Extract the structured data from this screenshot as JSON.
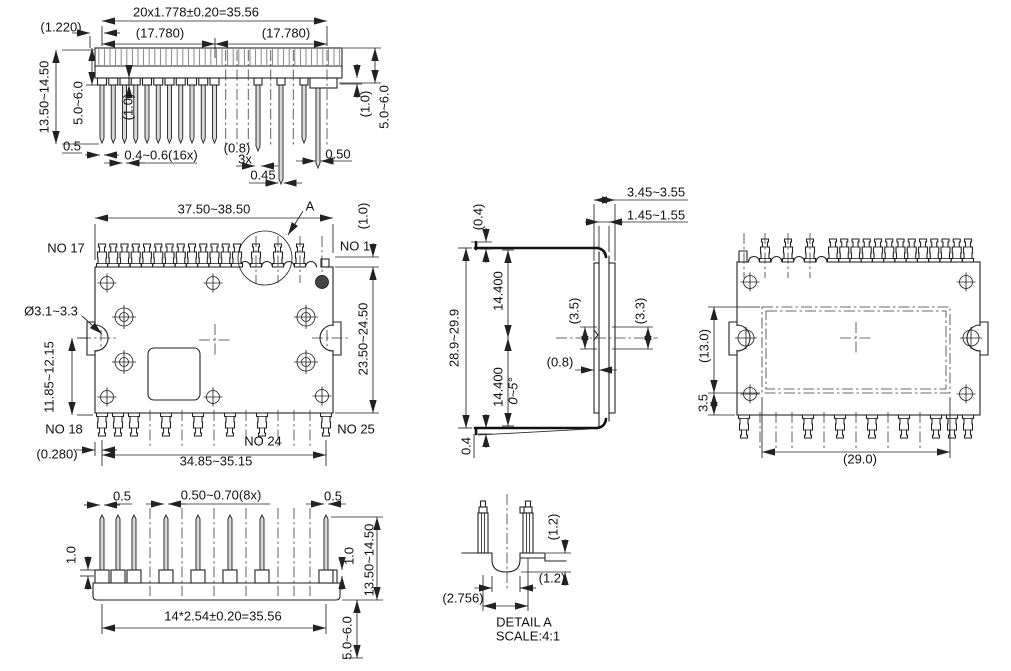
{
  "colors": {
    "line": "#222222",
    "background": "#ffffff"
  },
  "top_view": {
    "pitch_total": "20x1.778±0.20=35.56",
    "lead_offset": "(1.220)",
    "half_left": "(17.780)",
    "half_right": "(17.780)",
    "pin_length": "13.50~14.50",
    "shoulder_left": "5.0~6.0",
    "collar_left": "(1.0)",
    "edge_pin_width": "0.5",
    "narrow_pin_width": "0.4~0.6(16x)",
    "wide_pin_width": "(0.8)",
    "wide_pin_count": "3x",
    "pin_width_045": "0.45",
    "edge_pin_width_right": "0.50",
    "collar_right": "(1.0)",
    "shoulder_right": "5.0~6.0"
  },
  "front_view": {
    "body_width": "37.50~38.50",
    "detail_marker": "A",
    "pin_offset": "(1.0)",
    "pin_no_17": "NO 17",
    "pin_no_1": "NO 1",
    "hole_diameter": "Ø3.1~3.3",
    "hole_position": "11.85~12.15",
    "body_height": "23.50~24.50",
    "pin_no_18": "NO 18",
    "pin_no_24": "NO 24",
    "pin_no_25": "NO 25",
    "edge_offset": "(0.280)",
    "pin_span": "34.85~35.15"
  },
  "bottom_view": {
    "edge_pin_width_left": "0.5",
    "pin_width": "0.50~0.70(8x)",
    "edge_pin_width_right": "0.5",
    "collar_left": "1.0",
    "collar_right": "1.0",
    "pin_length": "13.50~14.50",
    "pitch_total": "14*2.54±0.20=35.56",
    "standoff": "5.0~6.0"
  },
  "side_view": {
    "total_thickness": "3.45~3.55",
    "body_thickness": "1.45~1.55",
    "tip_top": "(0.4)",
    "lead_span": "28.9~29.9",
    "half_span_top": "14.400",
    "half_span_bottom": "14.400",
    "dim_3_5": "(3.5)",
    "dim_3_3": "(3.3)",
    "dim_0_8": "(0.8)",
    "lead_angle": "0~5°",
    "tip_bottom": "0.4"
  },
  "back_view": {
    "pad_height": "(13.0)",
    "pad_offset": "3.5",
    "pad_width": "(29.0)"
  },
  "detail_view": {
    "notch_depth": "(1.2)",
    "notch_width": "(1.2)",
    "pin_pitch": "(2.756)",
    "title": "DETAIL A",
    "scale": "SCALE:4:1"
  }
}
